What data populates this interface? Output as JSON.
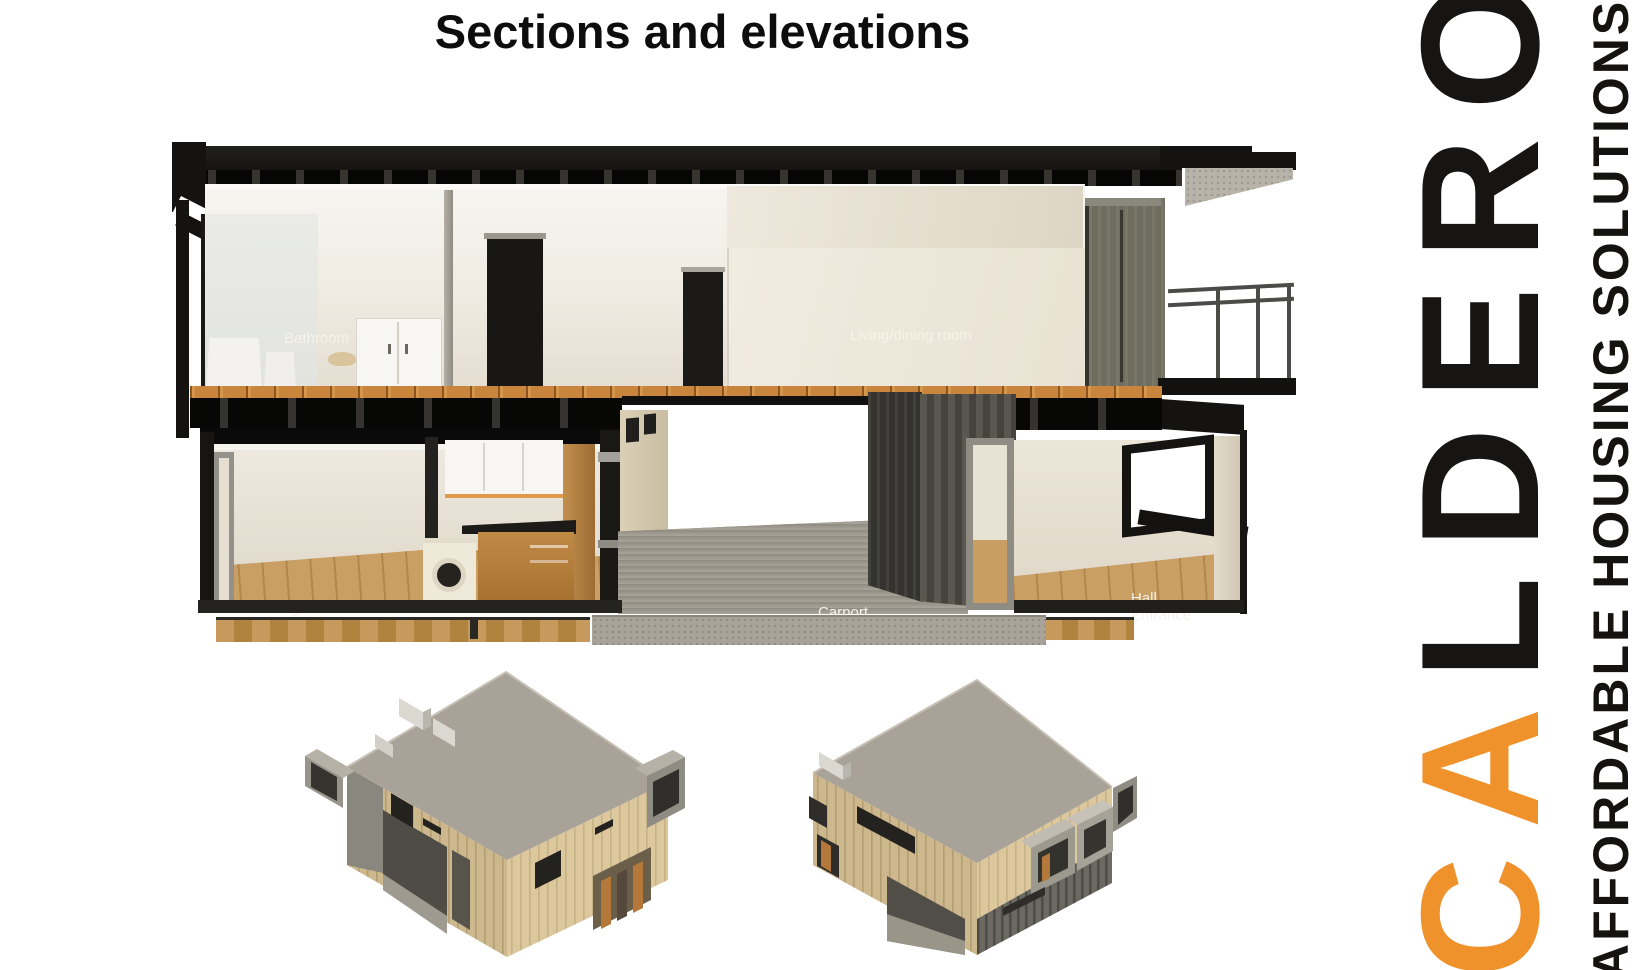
{
  "title": "Sections and elevations",
  "section_view": {
    "upper_floor_labels": [
      {
        "label": "Bathroom"
      },
      {
        "label": "Living/dining room"
      }
    ],
    "lower_floor_labels": [
      {
        "label": "Dining room"
      },
      {
        "label": "Kitchen"
      },
      {
        "label": "Carport"
      },
      {
        "label": "Hall\nEntrance"
      }
    ]
  },
  "logo": {
    "brand_prefix": "CA",
    "brand_suffix": "LDERON",
    "tagline": "AFFORDABLE HOUSING SOLUTIONS",
    "accent_color": "#F0922B"
  },
  "colors": {
    "accent_orange": "#F0922B",
    "structure_black": "#151412",
    "wall_cream": "#EFEBE2",
    "floor_wood": "#C9853C",
    "concrete_gray": "#A8A49A",
    "container_gray": "#4A4840",
    "house_roof_gray": "#A7A197",
    "house_wood_tan": "#D8C496"
  }
}
